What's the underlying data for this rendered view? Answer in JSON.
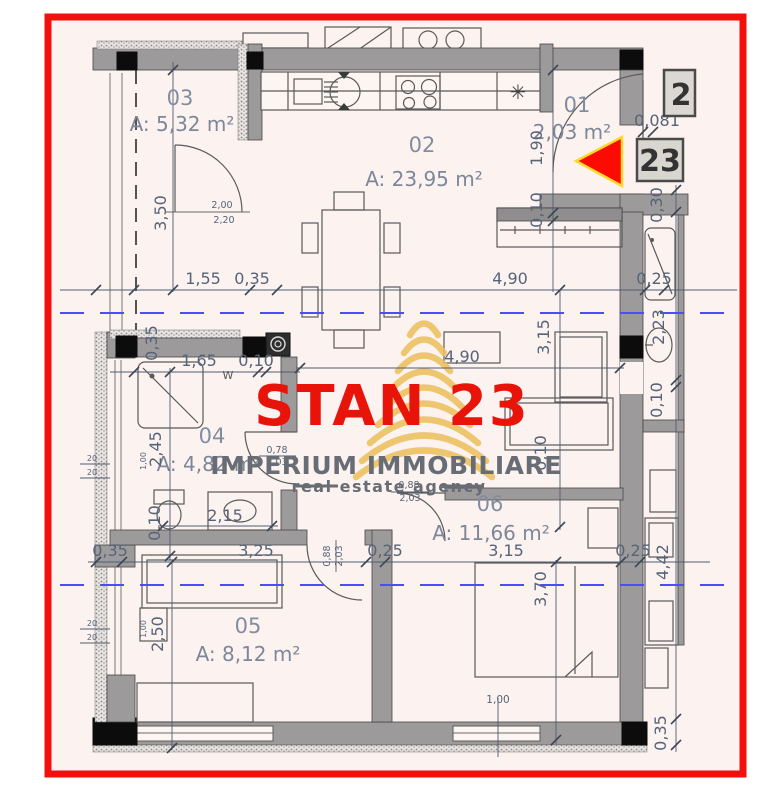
{
  "frame": {
    "color": "#f2100d"
  },
  "watermark": {
    "title": "STAN 23",
    "agency": "IMPERIUM IMMOBILIARE",
    "tagline": "real estate agency",
    "title_color": "#e8140a",
    "logo_color": "#ecc05e",
    "text_color": "#686d75"
  },
  "badges": {
    "neighbor_unit": "2",
    "unit_number": "23",
    "entry_dim": "0,081"
  },
  "rooms": [
    {
      "num": "03",
      "area": "A: 5,32 m²"
    },
    {
      "num": "02",
      "area": "A: 23,95 m²"
    },
    {
      "num": "01",
      "area": "2,03 m²"
    },
    {
      "num": "04",
      "area": "A: 4,82 m²"
    },
    {
      "num": "05",
      "area": "A: 8,12 m²"
    },
    {
      "num": "06",
      "area": "A: 11,66 m²"
    }
  ],
  "dims": {
    "w155": "1,55",
    "w035a": "0,35",
    "w490a": "4,90",
    "w025a": "0,25",
    "w165": "1,65",
    "w010a": "0,10",
    "w490b": "4,90",
    "w215": "2,15",
    "w035b": "0,35",
    "w325": "3,25",
    "w025b": "0,25",
    "w315a": "3,15",
    "w025c": "0,25",
    "v350": "3,50",
    "v190": "1,90",
    "v010a": "0,10",
    "v030": "0,30",
    "v223": "2,23",
    "v010b": "0,10",
    "v035a": "0,35",
    "v245": "2,45",
    "v010c": "0,10",
    "v315": "3,15",
    "v010d": "0,10",
    "v370": "3,70",
    "v250": "2,50",
    "v442": "4,42",
    "v035b": "0,35",
    "s100a": "1,00",
    "s100b": "1,00",
    "s100c": "1,00",
    "s20": "20",
    "door03_top": "2,00",
    "door03_bot": "2,20",
    "door04_top": "0,78",
    "door04_bot": "2,03",
    "door06_top": "0,88",
    "door06_bot": "2,03",
    "door05_a": "0,88",
    "door05_b": "2,03",
    "w_label": "W"
  },
  "symbols": {
    "kitchen_star": "✳"
  }
}
